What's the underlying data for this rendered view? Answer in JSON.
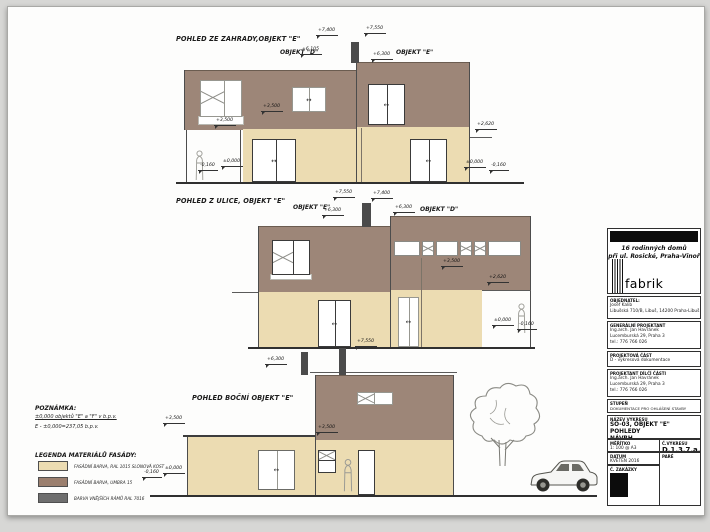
{
  "colors": {
    "facade_brown": "#9d8678",
    "facade_cream": "#ecdcb2",
    "frame_dark": "#3a3a3a"
  },
  "drawings": {
    "garden": {
      "title": "POHLED ZE ZAHRADY,OBJEKT \"E\"",
      "label_d": "OBJEKT \"D\"",
      "label_e": "OBJEKT \"E\"",
      "marks": {
        "t74": "+7,400",
        "t755": "+7,550",
        "p61": "+6,105",
        "p63": "+6,300",
        "f35a": "+3,500",
        "f35b": "+3,500",
        "c26": "+2,620",
        "z0l": "±0,000",
        "zml": "-0,160",
        "z0r": "±0,000",
        "zmr": "-0,160"
      }
    },
    "street": {
      "title": "POHLED Z ULICE, OBJEKT \"E\"",
      "label_e": "OBJEKT \"E\"",
      "label_d": "OBJEKT \"D\"",
      "marks": {
        "t755": "+7,550",
        "t74": "+7,400",
        "p63a": "+6,300",
        "p63b": "+6,300",
        "f35": "+3,500",
        "c26": "+2,620",
        "z0": "±0,000",
        "zm": "-0,160"
      }
    },
    "side": {
      "title": "POHLED BOČNÍ OBJEKT \"E\"",
      "marks": {
        "p63": "+6,300",
        "t755": "+7,550",
        "f35a": "+3,500",
        "f35b": "+3,500",
        "z0": "±0,000",
        "zm": "-0,160"
      }
    }
  },
  "notes": {
    "heading": "POZNÁMKA:",
    "line1": "±0,000 objektů \"E\" a \"F\" v b.p.v.",
    "line2": "E - ±0,000=237,05 b.p.v.",
    "legend_heading": "LEGENDA MATERIÁLŮ FASÁDY:",
    "legend": [
      {
        "color": "#ecdcb2",
        "label": "FASÁDNÍ BARVA, RAL 1015 SLONOVÁ KOST"
      },
      {
        "color": "#9b7f6e",
        "label": "FASÁDNÍ BARVA, UMBRA 15"
      },
      {
        "color": "#6e6e6e",
        "label": "BARVA VNĚJŠÍCH RÁMŮ RAL 7016"
      }
    ]
  },
  "titleblock": {
    "project_line1": "16 rodinných domů",
    "project_line2": "při ul. Rosické, Praha-Vinoř",
    "logo_text": "fabrik",
    "rows": [
      {
        "label": "OBJEDNATEL:",
        "lines": [
          "Josef Kalib",
          "Libušská 710/B, Libuš, 14200 Praha-Libuš"
        ]
      },
      {
        "label": "GENERÁLNÍ PROJEKTANT",
        "lines": [
          "Ing.arch. Jan Havránek",
          "Lucemburská 29, Praha 3",
          "tel.: 776 766 026"
        ]
      },
      {
        "label": "PROJEKTOVÁ ČÁST",
        "lines": [
          "D - výkresová dokumentace"
        ]
      },
      {
        "label": "PROJEKTANT DÍLČÍ ČÁSTI",
        "lines": [
          "Ing.arch. Jan Havránek",
          "Lucemburská 29, Praha 3",
          "tel.: 776 766 026"
        ]
      },
      {
        "label": "STUPEŇ",
        "lines": [
          "DOKUMENTACE PRO OHLÁŠENÍ STAVBY"
        ]
      },
      {
        "label": "NÁZEV VÝKRESU",
        "lines": [
          "SO-03, OBJEKT \"E\"",
          "POHLEDY",
          "NÁVRH"
        ]
      }
    ],
    "meritko_label": "MĚŘÍTKO",
    "meritko": "1: 100 @ A3",
    "cvykresu_label": "Č.VÝKRESU",
    "cvykresu": "D.1.3.7.a.",
    "datum_label": "DATUM",
    "datum": "KVĚTEN 2016",
    "pare_label": "PARÉ",
    "zakazky_label": "Č. ZAKÁZKY"
  }
}
